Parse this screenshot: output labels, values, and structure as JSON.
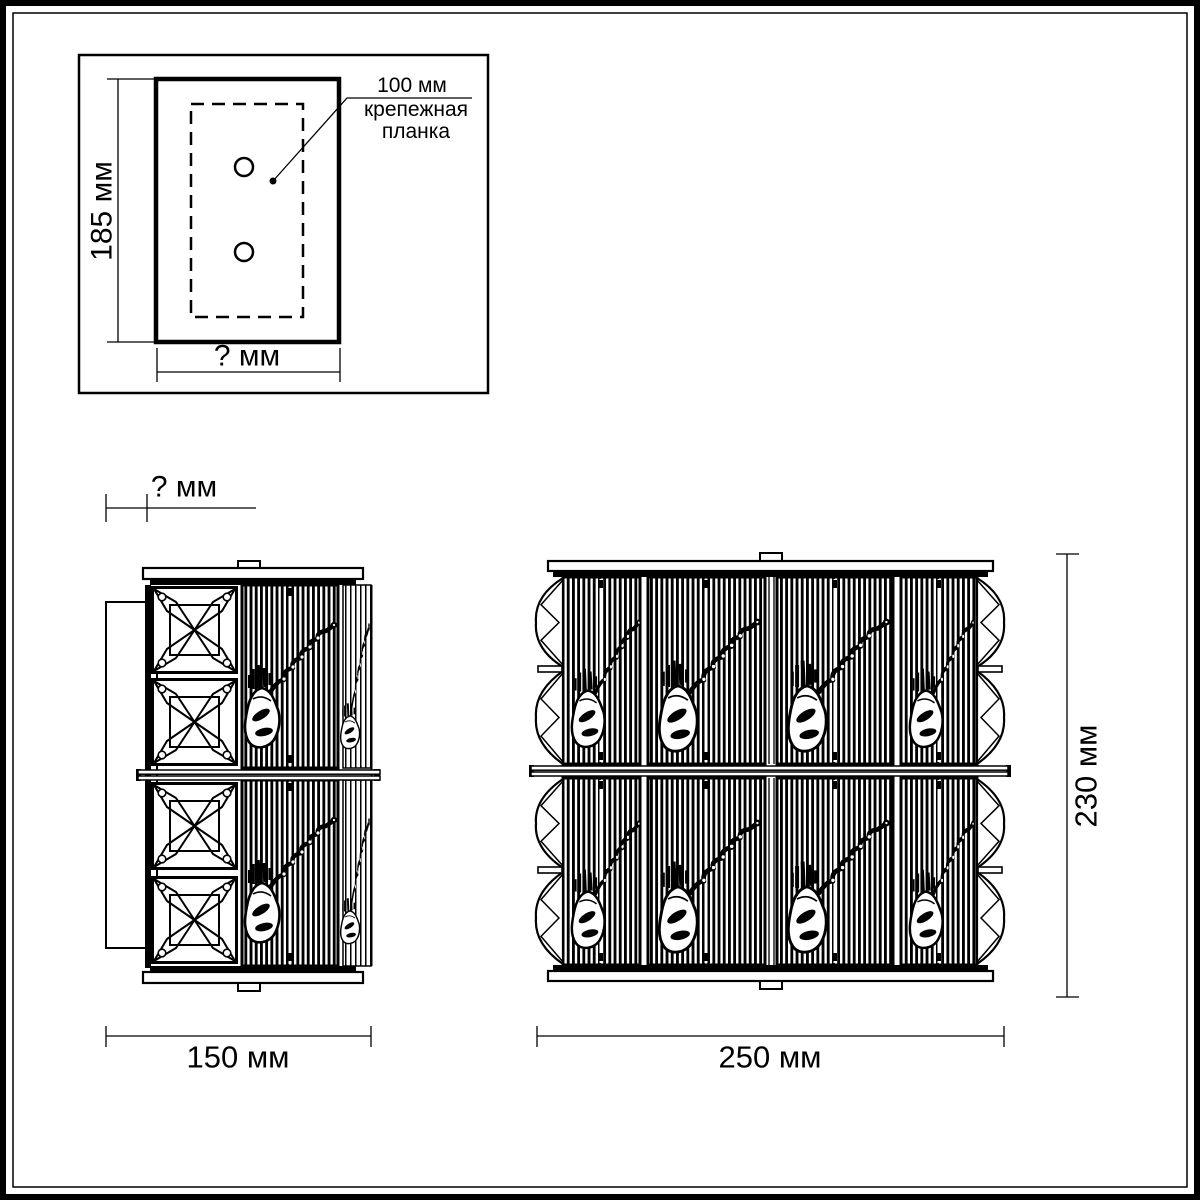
{
  "page": {
    "paper": "#ffffff",
    "ink": "#000000"
  },
  "detail_box": {
    "plate_dim": "100 мм",
    "plate_caption": "крепежная планка",
    "height_dim": "185 мм",
    "width_dim": "? мм"
  },
  "side_view": {
    "depth_dim": "? мм",
    "width_dim": "150 мм"
  },
  "front_view": {
    "width_dim": "250 мм",
    "height_dim": "230 мм"
  }
}
